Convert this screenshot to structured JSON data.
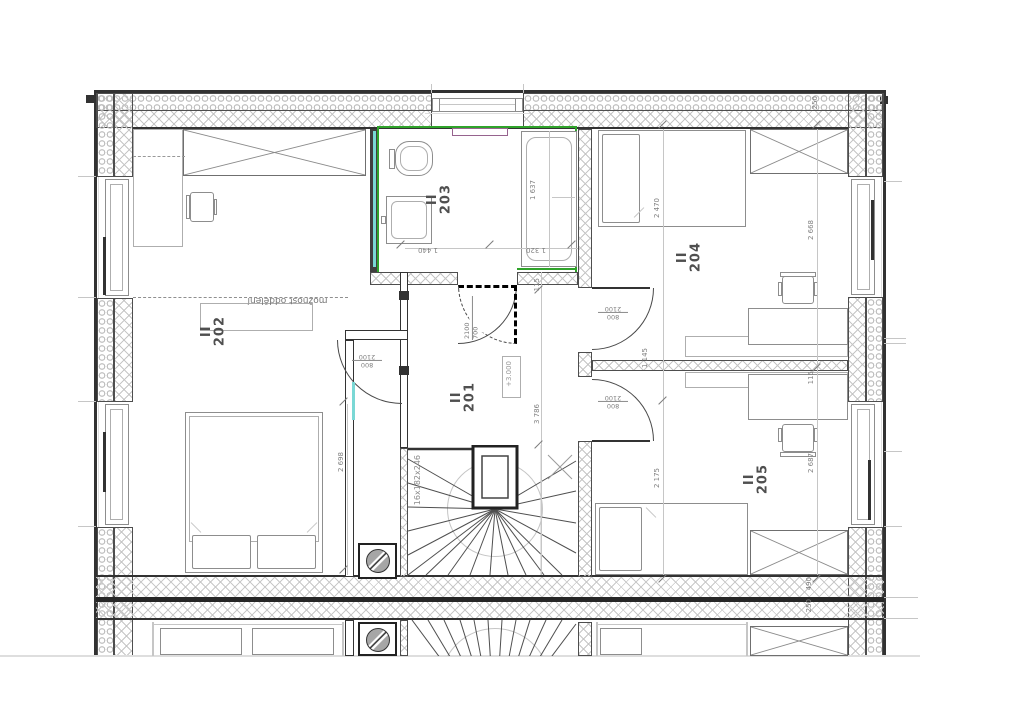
{
  "drawing": {
    "rooms": {
      "r201": {
        "prefix": "II",
        "number": "201"
      },
      "r202": {
        "prefix": "II",
        "number": "202"
      },
      "r203": {
        "prefix": "II",
        "number": "203"
      },
      "r204": {
        "prefix": "II",
        "number": "204"
      },
      "r205": {
        "prefix": "II",
        "number": "205"
      }
    },
    "level_mark": "+3.000",
    "stair_note": "16x182x246",
    "separation_note": "možnost oddělení",
    "dims": {
      "tub": "1 637",
      "bath_left": "1 440",
      "bath_right": "1 320",
      "off115": "115",
      "hall_depth": "3 786",
      "w202": "2 698",
      "d204": "2 470",
      "w204": "2 668",
      "p1145": "1 145",
      "d205": "2 175",
      "w205": "2 687",
      "top250": "250",
      "party490": "490",
      "party250": "250"
    },
    "doors": {
      "bath": {
        "height": "2100",
        "width": "700"
      },
      "std": {
        "height": "2100",
        "width": "800"
      }
    },
    "colors": {
      "highlight_green": "#2fa32a",
      "accent_cyan": "#7ad8d5",
      "radiator_purple": "#96638e",
      "line_dark": "#323232",
      "hatch_gray": "#c6c6c6",
      "dim_gray": "#7f7f7f"
    }
  }
}
